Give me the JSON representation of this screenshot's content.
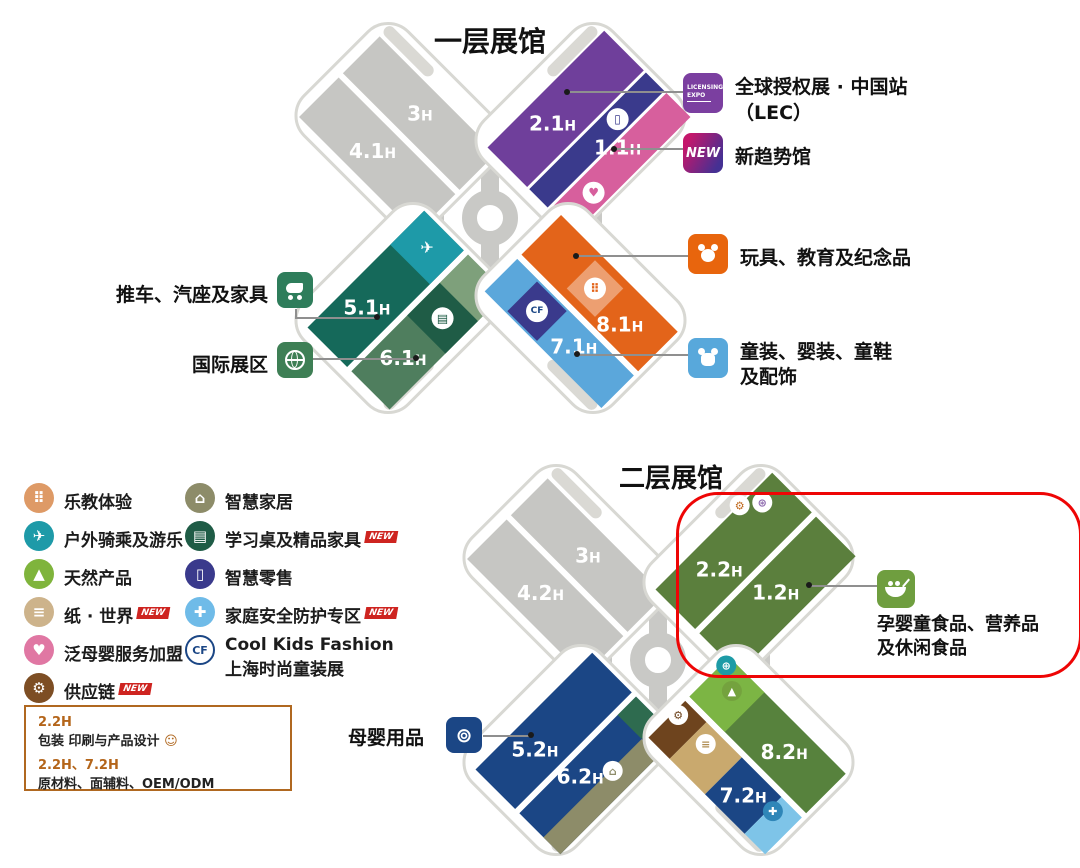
{
  "floor1": {
    "title": "一层展馆",
    "halls": {
      "h3": {
        "n": "3",
        "h": "H"
      },
      "h41": {
        "n": "4.1",
        "h": "H"
      },
      "h21": {
        "n": "2.1",
        "h": "H"
      },
      "h11": {
        "n": "1.1",
        "h": "H"
      },
      "h51": {
        "n": "5.1",
        "h": "H"
      },
      "h61": {
        "n": "6.1",
        "h": "H"
      },
      "h81": {
        "n": "8.1",
        "h": "H"
      },
      "h71": {
        "n": "7.1",
        "h": "H"
      }
    },
    "labels": {
      "lec": {
        "text1": "全球授权展 · 中国站",
        "text2": "（LEC）",
        "icon_line1": "LICENSING",
        "icon_line2": "EXPO"
      },
      "new_trend": {
        "text": "新趋势馆",
        "badge": "NEW"
      },
      "toys": {
        "text": "玩具、教育及纪念品"
      },
      "kidswear": {
        "text1": "童装、婴装、童鞋",
        "text2": "及配饰"
      },
      "stroller": {
        "text": "推车、汽座及家具"
      },
      "international": {
        "text": "国际展区"
      }
    }
  },
  "floor2": {
    "title": "二层展馆",
    "halls": {
      "h3": {
        "n": "3",
        "h": "H"
      },
      "h42": {
        "n": "4.2",
        "h": "H"
      },
      "h22": {
        "n": "2.2",
        "h": "H"
      },
      "h12": {
        "n": "1.2",
        "h": "H"
      },
      "h52": {
        "n": "5.2",
        "h": "H"
      },
      "h62": {
        "n": "6.2",
        "h": "H"
      },
      "h82": {
        "n": "8.2",
        "h": "H"
      },
      "h72": {
        "n": "7.2",
        "h": "H"
      }
    },
    "labels": {
      "maternity": {
        "text": "母婴用品"
      },
      "food": {
        "text1": "孕婴童食品、营养品",
        "text2": "及休闲食品"
      }
    }
  },
  "legend": {
    "new_badge": "NEW",
    "col1": [
      {
        "label": "乐教体验"
      },
      {
        "label": "户外骑乘及游乐"
      },
      {
        "label": "天然产品"
      },
      {
        "label": "纸 · 世界",
        "new": true
      },
      {
        "label": "泛母婴服务加盟"
      },
      {
        "label": "供应链",
        "new": true
      }
    ],
    "col2": [
      {
        "label": "智慧家居"
      },
      {
        "label": "学习桌及精品家具",
        "new": true
      },
      {
        "label": "智慧零售"
      },
      {
        "label": "家庭安全防护专区",
        "new": true
      },
      {
        "label": "Cool Kids Fashion",
        "label2": "上海时尚童装展"
      }
    ]
  },
  "info_box": {
    "line1_halls": "2.2H",
    "line1_text": "包装 印刷与产品设计",
    "line2_halls": "2.2H、7.2H",
    "line2_text": "原材料、面辅料、OEM/ODM"
  },
  "icons": {
    "blocks": "⠿",
    "plane": "✈",
    "mountain": "▲",
    "paper": "≡",
    "heart": "♥",
    "gears": "⚙",
    "house": "⌂",
    "desk": "▤",
    "phone": "▯",
    "shield": "✚",
    "globe": "⊕",
    "cf": "CF",
    "packaging": "⊛",
    "face": "☺",
    "pacifier": "⊚"
  },
  "colors": {
    "gray_hall": "#c6c6c3",
    "purple": "#6f3f9b",
    "indigo": "#3a3a8c",
    "pink": "#d75f9d",
    "dark_teal_green": "#15695a",
    "teal": "#1e9aa8",
    "sage": "#4f7e5e",
    "light_sage": "#7ea07b",
    "dark_green": "#1f5c46",
    "orange": "#e3641a",
    "light_blue": "#5ba7db",
    "olive_green": "#5b7f3d",
    "navy": "#1b4685",
    "olive": "#8d8c69",
    "hall8_2_green": "#57823d",
    "bright_green": "#7cb544",
    "tan": "#c9a96e",
    "brown": "#6e441e",
    "sky_blue": "#7ec4e8",
    "food_green": "#6f9e3f",
    "label_green": "#2e7d5b",
    "annotation_red": "#ee0505",
    "new_red": "#ce2420",
    "box_border": "#b06820"
  }
}
